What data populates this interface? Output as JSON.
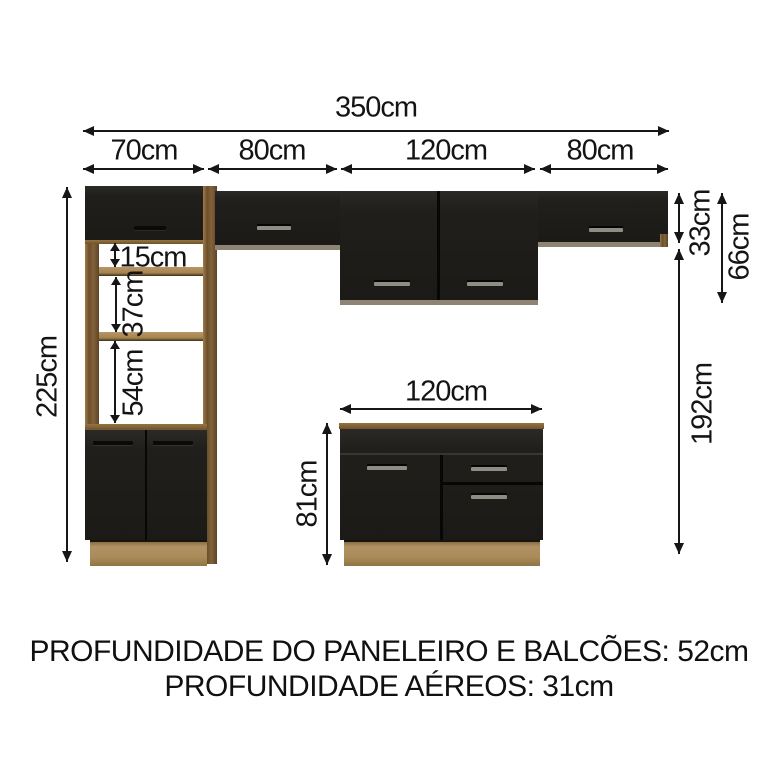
{
  "diagram": {
    "dims": {
      "total": "350cm",
      "seg_70": "70cm",
      "seg_80a": "80cm",
      "seg_120": "120cm",
      "seg_80b": "80cm",
      "height_total": "225cm",
      "niche_15": "15cm",
      "niche_37": "37cm",
      "niche_54": "54cm",
      "aereo_33": "33cm",
      "aereo_66": "66cm",
      "gap_192": "192cm",
      "base_width": "120cm",
      "base_height": "81cm"
    },
    "footer": {
      "line1": "PROFUNDIDADE DO PANELEIRO E BALCÕES: 52cm",
      "line2": "PROFUNDIDADE AÉREOS: 31cm"
    },
    "colors": {
      "door": "#201f1c",
      "wood_dark": "#7d5e38",
      "wood_light": "#ab8a55",
      "dimension_line": "#161616",
      "background": "#ffffff"
    }
  }
}
